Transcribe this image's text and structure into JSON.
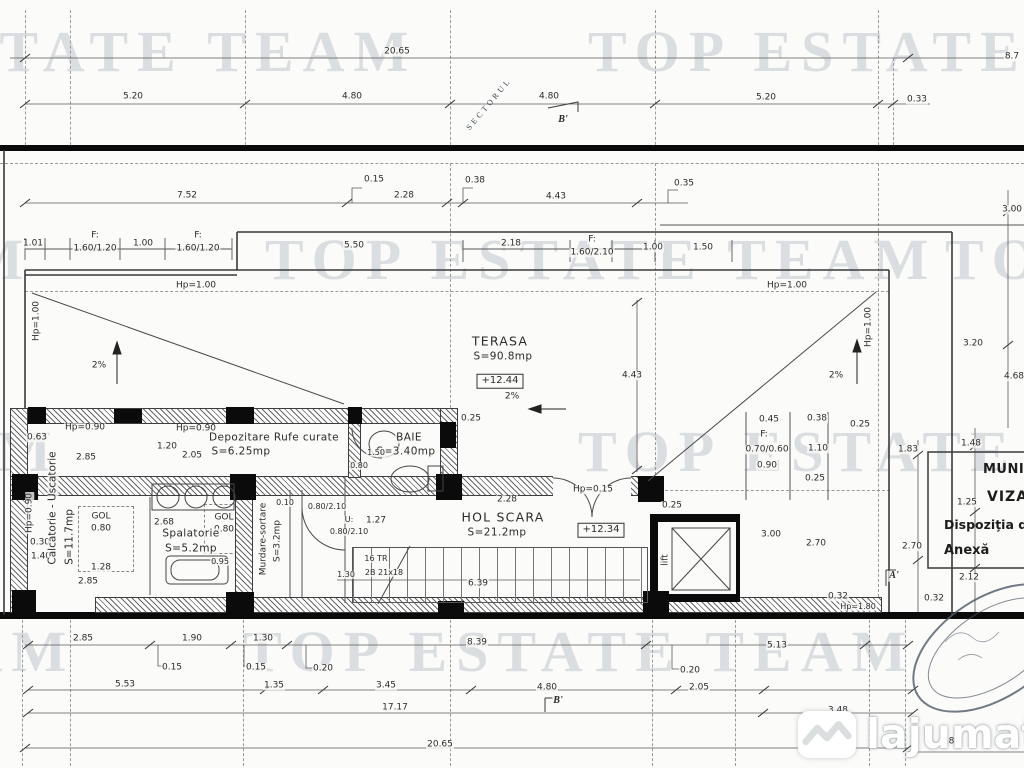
{
  "watermark": {
    "text": "TOP ESTATE TEAM"
  },
  "seal": {
    "text": "SECTORUL"
  },
  "logo": {
    "name": "lajumate",
    "tld": ".ro"
  },
  "stamp": {
    "l1": "MUNICIPIUL",
    "l2": "VIZAT",
    "l3": "Dispoziţia de",
    "l4": "Anexă"
  },
  "labels": [
    {
      "t": "20.65",
      "x": 397,
      "y": 52
    },
    {
      "t": "8.7",
      "x": 1012,
      "y": 57
    },
    {
      "t": "5.20",
      "x": 133,
      "y": 97
    },
    {
      "t": "4.80",
      "x": 352,
      "y": 97
    },
    {
      "t": "4.80",
      "x": 549,
      "y": 97
    },
    {
      "t": "5.20",
      "x": 766,
      "y": 98
    },
    {
      "t": "0.33",
      "x": 917,
      "y": 100
    },
    {
      "t": "7.52",
      "x": 187,
      "y": 196
    },
    {
      "t": "0.15",
      "x": 374,
      "y": 180
    },
    {
      "t": "2.28",
      "x": 404,
      "y": 196
    },
    {
      "t": "0.38",
      "x": 475,
      "y": 181
    },
    {
      "t": "4.43",
      "x": 556,
      "y": 197
    },
    {
      "t": "0.35",
      "x": 684,
      "y": 184
    },
    {
      "t": "3.00",
      "x": 1012,
      "y": 210
    },
    {
      "t": "1.01",
      "x": 33,
      "y": 244
    },
    {
      "t": "F:",
      "x": 95,
      "y": 236
    },
    {
      "t": "1.60/1.20",
      "x": 95,
      "y": 249
    },
    {
      "t": "1.00",
      "x": 143,
      "y": 244
    },
    {
      "t": "F:",
      "x": 198,
      "y": 236
    },
    {
      "t": "1.60/1.20",
      "x": 198,
      "y": 249
    },
    {
      "t": "5.50",
      "x": 354,
      "y": 246
    },
    {
      "t": "2.18",
      "x": 511,
      "y": 244
    },
    {
      "t": "F:",
      "x": 592,
      "y": 240
    },
    {
      "t": "1.60/2.10",
      "x": 592,
      "y": 253
    },
    {
      "t": "1.00",
      "x": 653,
      "y": 248
    },
    {
      "t": "1.50",
      "x": 703,
      "y": 248
    },
    {
      "t": "Hp=1.00",
      "x": 196,
      "y": 286
    },
    {
      "t": "Hp=1.00",
      "x": 787,
      "y": 286
    },
    {
      "t": "2%",
      "x": 99,
      "y": 366
    },
    {
      "t": "2%",
      "x": 836,
      "y": 376
    },
    {
      "t": "2%",
      "x": 512,
      "y": 397
    },
    {
      "t": "TERASA",
      "x": 500,
      "y": 341,
      "c": "rb"
    },
    {
      "t": "S=90.8mp",
      "x": 503,
      "y": 357,
      "c": "r"
    },
    {
      "t": "+12.44",
      "x": 500,
      "y": 381,
      "c": "bx"
    },
    {
      "t": "4.43",
      "x": 632,
      "y": 376
    },
    {
      "t": "3.20",
      "x": 973,
      "y": 344
    },
    {
      "t": "4.68",
      "x": 1014,
      "y": 377
    },
    {
      "t": "0.25",
      "x": 471,
      "y": 419
    },
    {
      "t": "Hp=0.90",
      "x": 85,
      "y": 428
    },
    {
      "t": "0.63",
      "x": 37,
      "y": 438
    },
    {
      "t": "2.85",
      "x": 86,
      "y": 458
    },
    {
      "t": "1.20",
      "x": 167,
      "y": 447
    },
    {
      "t": "2.05",
      "x": 192,
      "y": 456
    },
    {
      "t": "Hp=0.90",
      "x": 196,
      "y": 429
    },
    {
      "t": "Depozitare Rufe curate",
      "x": 274,
      "y": 438,
      "c": "r"
    },
    {
      "t": "S=6.25mp",
      "x": 241,
      "y": 452,
      "c": "r"
    },
    {
      "t": "BAIE",
      "x": 409,
      "y": 438,
      "c": "r"
    },
    {
      "t": "S=3.40mp",
      "x": 406,
      "y": 452,
      "c": "r"
    },
    {
      "t": "1.50",
      "x": 376,
      "y": 453,
      "c": "sm"
    },
    {
      "t": "0.80",
      "x": 359,
      "y": 466,
      "c": "sm"
    },
    {
      "t": "GOL",
      "x": 101,
      "y": 517
    },
    {
      "t": "0.80",
      "x": 101,
      "y": 529
    },
    {
      "t": "GOL",
      "x": 224,
      "y": 518
    },
    {
      "t": "0.80",
      "x": 224,
      "y": 530
    },
    {
      "t": "2.68",
      "x": 164,
      "y": 523
    },
    {
      "t": "Spalatorie",
      "x": 191,
      "y": 534,
      "c": "r"
    },
    {
      "t": "S=5.2mp",
      "x": 191,
      "y": 549,
      "c": "r"
    },
    {
      "t": "0.95",
      "x": 220,
      "y": 562,
      "c": "sm"
    },
    {
      "t": "0.30",
      "x": 40,
      "y": 543
    },
    {
      "t": "1.40",
      "x": 41,
      "y": 557
    },
    {
      "t": "1.28",
      "x": 101,
      "y": 568
    },
    {
      "t": "2.85",
      "x": 88,
      "y": 582
    },
    {
      "t": "0.10",
      "x": 285,
      "y": 503,
      "c": "sm"
    },
    {
      "t": "0.80/2.10",
      "x": 327,
      "y": 507,
      "c": "sm"
    },
    {
      "t": "U:",
      "x": 349,
      "y": 520,
      "c": "sm"
    },
    {
      "t": "0.80/2.10",
      "x": 349,
      "y": 532,
      "c": "sm"
    },
    {
      "t": "1.27",
      "x": 376,
      "y": 521
    },
    {
      "t": "2.28",
      "x": 507,
      "y": 500
    },
    {
      "t": "Hp=0.15",
      "x": 593,
      "y": 490
    },
    {
      "t": "HOL SCARA",
      "x": 503,
      "y": 517,
      "c": "rb"
    },
    {
      "t": "S=21.2mp",
      "x": 497,
      "y": 533,
      "c": "r"
    },
    {
      "t": "+12.34",
      "x": 601,
      "y": 530,
      "c": "bx"
    },
    {
      "t": "16 TR",
      "x": 376,
      "y": 559,
      "c": "sm"
    },
    {
      "t": "2B 21x18",
      "x": 384,
      "y": 573,
      "c": "sm"
    },
    {
      "t": "1.30",
      "x": 346,
      "y": 575,
      "c": "sm"
    },
    {
      "t": "6.39",
      "x": 478,
      "y": 584
    },
    {
      "t": "0.25",
      "x": 672,
      "y": 506
    },
    {
      "t": "0.45",
      "x": 769,
      "y": 420
    },
    {
      "t": "0.38",
      "x": 817,
      "y": 419
    },
    {
      "t": "0.25",
      "x": 860,
      "y": 425
    },
    {
      "t": "F:",
      "x": 764,
      "y": 435
    },
    {
      "t": "0.70/0.60",
      "x": 767,
      "y": 450
    },
    {
      "t": "1.10",
      "x": 818,
      "y": 449
    },
    {
      "t": "0.90",
      "x": 767,
      "y": 466
    },
    {
      "t": "0.25",
      "x": 815,
      "y": 479
    },
    {
      "t": "3.00",
      "x": 771,
      "y": 535
    },
    {
      "t": "2.70",
      "x": 816,
      "y": 544
    },
    {
      "t": "0.32",
      "x": 838,
      "y": 597
    },
    {
      "t": "Hp=1.80",
      "x": 858,
      "y": 607,
      "c": "sm"
    },
    {
      "t": "1.83",
      "x": 908,
      "y": 450
    },
    {
      "t": "1.48",
      "x": 971,
      "y": 444
    },
    {
      "t": "1.25",
      "x": 967,
      "y": 503
    },
    {
      "t": "2.70",
      "x": 912,
      "y": 547
    },
    {
      "t": "2.12",
      "x": 969,
      "y": 578
    },
    {
      "t": "0.32",
      "x": 934,
      "y": 599
    },
    {
      "t": "B'",
      "x": 563,
      "y": 120,
      "c": "mk"
    },
    {
      "t": "B'",
      "x": 558,
      "y": 701,
      "c": "mk"
    },
    {
      "t": "A'",
      "x": 894,
      "y": 576,
      "c": "mk"
    },
    {
      "t": "2.85",
      "x": 83,
      "y": 639
    },
    {
      "t": "1.90",
      "x": 192,
      "y": 639
    },
    {
      "t": "1.30",
      "x": 263,
      "y": 639
    },
    {
      "t": "8.39",
      "x": 477,
      "y": 643
    },
    {
      "t": "5.13",
      "x": 777,
      "y": 646
    },
    {
      "t": "0.15",
      "x": 172,
      "y": 668
    },
    {
      "t": "0.15",
      "x": 256,
      "y": 668
    },
    {
      "t": "0.20",
      "x": 323,
      "y": 669
    },
    {
      "t": "0.20",
      "x": 690,
      "y": 671
    },
    {
      "t": "5.53",
      "x": 125,
      "y": 685
    },
    {
      "t": "1.35",
      "x": 274,
      "y": 686
    },
    {
      "t": "3.45",
      "x": 386,
      "y": 686
    },
    {
      "t": "4.80",
      "x": 547,
      "y": 688
    },
    {
      "t": "2.05",
      "x": 699,
      "y": 688
    },
    {
      "t": "3.48",
      "x": 838,
      "y": 711
    },
    {
      "t": "17.17",
      "x": 395,
      "y": 708
    },
    {
      "t": "20.65",
      "x": 440,
      "y": 745
    },
    {
      "t": "6.81",
      "x": 950,
      "y": 742
    },
    {
      "t": "Calcatorie - Uscatorie",
      "x": 53,
      "y": 508,
      "c": "v"
    },
    {
      "t": "S=11.7mp",
      "x": 70,
      "y": 537,
      "c": "v"
    },
    {
      "t": "Murdare-sortare",
      "x": 264,
      "y": 539,
      "c": "vs"
    },
    {
      "t": "S=3.2mp",
      "x": 278,
      "y": 541,
      "c": "vs"
    },
    {
      "t": "Hp=1.00",
      "x": 37,
      "y": 321,
      "c": "vs"
    },
    {
      "t": "Hp=1.00",
      "x": 869,
      "y": 327,
      "c": "vs"
    },
    {
      "t": "Hp=0.90",
      "x": 30,
      "y": 513,
      "c": "vs"
    },
    {
      "t": "lift",
      "x": 666,
      "y": 560,
      "c": "vs"
    }
  ]
}
